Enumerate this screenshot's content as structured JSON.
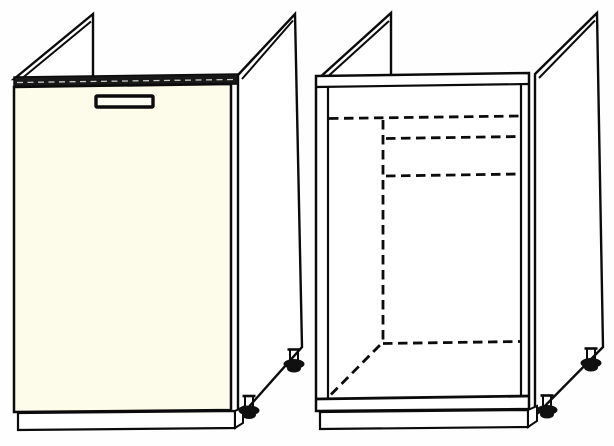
{
  "figure": {
    "type": "technical line drawing",
    "subject": "Kitchen sink base cabinet shown in two views",
    "views": [
      {
        "id": "assembled-view",
        "label": "Assembled sink base cabinet with cream door, recessed handle, plinth and adjustable feet"
      },
      {
        "id": "carcass-view",
        "label": "Open carcass view of the same cabinet with hidden interior edges drawn as dashed lines"
      }
    ]
  },
  "colors": {
    "background": "#fefefe",
    "line": "#0b0b0b",
    "door_fill": "#fdfbe9",
    "panel_fill": "#ffffff",
    "foot_fill": "#101010",
    "band_fill": "#181818",
    "band_highlight": "#c9c9c9",
    "handle_fill": "#fffef4"
  },
  "parts": {
    "assembled_view": [
      "left side panel (raised for sink)",
      "right side panel (raised for sink)",
      "top front rail",
      "cream door",
      "door handle",
      "plinth",
      "front adjustable foot",
      "back adjustable foot"
    ],
    "carcass_view": [
      "left side panel (raised for sink)",
      "right side panel (raised for sink)",
      "top front rail",
      "open face frame",
      "hidden back-panel edge (dashed vertical)",
      "hidden rail edges (dashed horizontals)",
      "hidden floor back edge (dashed)",
      "hidden floor side edge (dashed diagonal)",
      "bottom shelf front edge",
      "plinth",
      "front adjustable foot",
      "back adjustable foot"
    ]
  }
}
